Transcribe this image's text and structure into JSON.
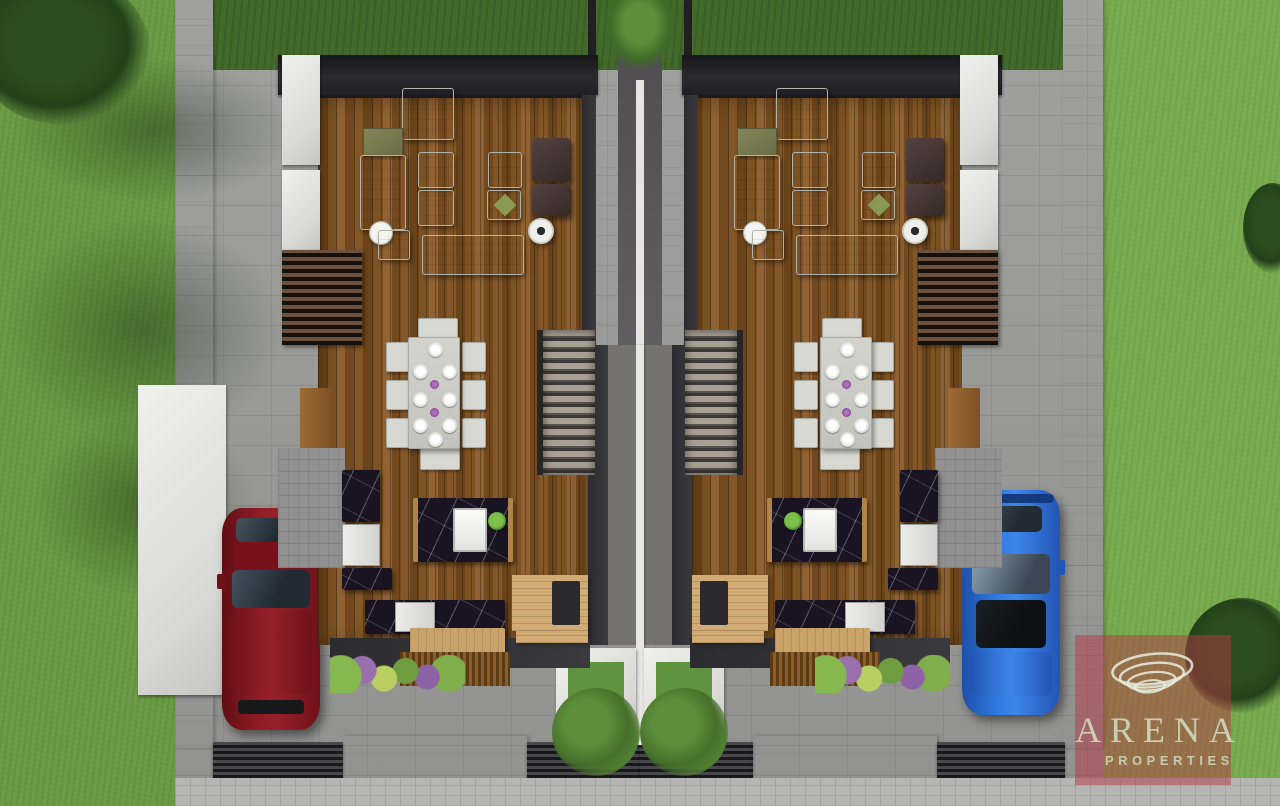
{
  "watermark": {
    "brand": "ARENA",
    "tagline": "PROPERTIES",
    "icon": "spiral-ellipses-icon",
    "overlay_color": "rgba(180,55,70,0.50)",
    "text_color": "#ccd5b9"
  },
  "vehicles": [
    {
      "name": "red-car",
      "color": "#8e1b24",
      "position": "left-driveway"
    },
    {
      "name": "blue-car",
      "color": "#2f79e0",
      "position": "right-driveway"
    }
  ],
  "units": [
    {
      "name": "unit-left",
      "rooms": [
        "living-room",
        "dining-area",
        "kitchen",
        "staircase",
        "entry-deck"
      ]
    },
    {
      "name": "unit-right",
      "rooms": [
        "living-room",
        "dining-area",
        "kitchen",
        "staircase",
        "entry-deck"
      ]
    }
  ],
  "palette": {
    "grass_left": "#6a9a44",
    "grass_right": "#78ab4e",
    "backyard_grass": "#436a2b",
    "pavement": "#9b9b99",
    "sidewalk": "#b5b6b3",
    "wall_white": "#e8e9e5",
    "wood_floor": "#7c5122",
    "deck_wood": "#d2ab74",
    "marble_black": "#191322",
    "roof_dark": "#26262a",
    "sofa_white": "#dfdfdb",
    "chair_dark": "#463634",
    "planter_green": "#5f9340"
  }
}
